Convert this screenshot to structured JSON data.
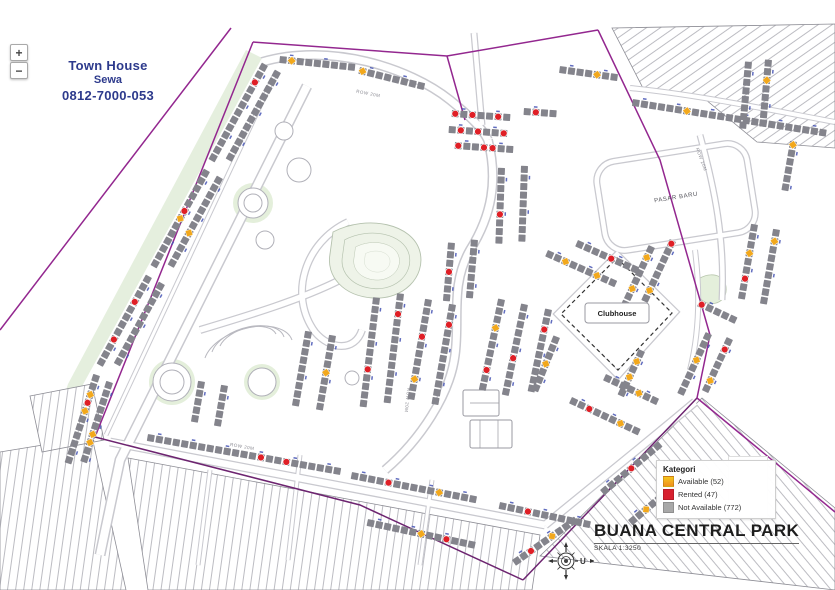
{
  "controls": {
    "zoom_in": "+",
    "zoom_out": "−"
  },
  "ad": {
    "line1": "Town House",
    "line2": "Sewa",
    "line3": "0812-7000-053",
    "color": "#2d3a8c"
  },
  "legend": {
    "title": "Kategori",
    "items": [
      {
        "label": "Available (52)",
        "color": "#f6c61d",
        "color2": "#ef8f1e"
      },
      {
        "label": "Rented (47)",
        "color": "#d7202f"
      },
      {
        "label": "Not Available (772)",
        "color": "#a8a8a8"
      }
    ]
  },
  "footer": {
    "title": "BUANA CENTRAL PARK",
    "scale": "SKALA  1:3250",
    "compass": "U"
  },
  "map": {
    "labels": {
      "clubhouse": "Clubhouse",
      "pasar": "PASAR BARU"
    },
    "road_labels": [
      {
        "t": "ROW 20M",
        "x": 368,
        "y": 95,
        "a": 11
      },
      {
        "t": "ROW 20M",
        "x": 242,
        "y": 448,
        "a": 10
      },
      {
        "t": "ROW 20M",
        "x": 406,
        "y": 400,
        "a": 96
      },
      {
        "t": "ROW 20M",
        "x": 700,
        "y": 160,
        "a": 70
      }
    ],
    "colors": {
      "boundary": "#93278f",
      "unit": "#84848c",
      "rented": "#df1f26",
      "available": "#f2a81c",
      "tick": "#4553b4",
      "road": "#c9c9cf"
    },
    "rows": [
      {
        "x": 268,
        "y": 66,
        "a": 119,
        "n": 13,
        "m": {
          "2": "R"
        }
      },
      {
        "x": 210,
        "y": 172,
        "a": 119,
        "n": 13,
        "m": {
          "5": "R",
          "6": "A"
        }
      },
      {
        "x": 152,
        "y": 278,
        "a": 119,
        "n": 12,
        "m": {
          "3": "R",
          "8": "R"
        }
      },
      {
        "x": 100,
        "y": 376,
        "a": 108,
        "n": 11,
        "m": {
          "2": "A",
          "3": "R",
          "4": "A"
        }
      },
      {
        "x": 281,
        "y": 73,
        "a": 119,
        "n": 12
      },
      {
        "x": 223,
        "y": 179,
        "a": 119,
        "n": 12,
        "m": {
          "7": "A"
        }
      },
      {
        "x": 165,
        "y": 285,
        "a": 119,
        "n": 11
      },
      {
        "x": 113,
        "y": 383,
        "a": 108,
        "n": 10,
        "m": {
          "6": "A",
          "7": "A"
        }
      },
      {
        "x": 280,
        "y": 56,
        "a": 6,
        "n": 9,
        "m": {
          "1": "A"
        }
      },
      {
        "x": 360,
        "y": 67,
        "a": 14,
        "n": 8,
        "m": {
          "0": "A"
        }
      },
      {
        "x": 452,
        "y": 110,
        "a": 4,
        "n": 7,
        "m": {
          "0": "R",
          "2": "R",
          "5": "R"
        }
      },
      {
        "x": 449,
        "y": 126,
        "a": 4,
        "n": 7,
        "m": {
          "1": "R",
          "3": "R",
          "6": "R"
        }
      },
      {
        "x": 455,
        "y": 142,
        "a": 4,
        "n": 7,
        "m": {
          "0": "R",
          "3": "R",
          "4": "R"
        }
      },
      {
        "x": 524,
        "y": 108,
        "a": 4,
        "n": 4,
        "m": {
          "1": "R"
        }
      },
      {
        "x": 560,
        "y": 66,
        "a": 8,
        "n": 7,
        "m": {
          "4": "A"
        }
      },
      {
        "x": 633,
        "y": 99,
        "a": 9,
        "n": 23,
        "m": {
          "6": "A"
        }
      },
      {
        "x": 752,
        "y": 62,
        "a": 95,
        "n": 8
      },
      {
        "x": 772,
        "y": 60,
        "a": 95,
        "n": 8,
        "m": {
          "2": "A"
        }
      },
      {
        "x": 797,
        "y": 142,
        "a": 100,
        "n": 6,
        "m": {
          "0": "A"
        }
      },
      {
        "x": 758,
        "y": 225,
        "a": 100,
        "n": 9,
        "m": {
          "3": "A",
          "6": "R"
        }
      },
      {
        "x": 780,
        "y": 230,
        "a": 100,
        "n": 9,
        "m": {
          "1": "A"
        }
      },
      {
        "x": 380,
        "y": 298,
        "a": 97,
        "n": 13,
        "m": {
          "8": "R"
        }
      },
      {
        "x": 404,
        "y": 294,
        "a": 97,
        "n": 13,
        "m": {
          "2": "R"
        }
      },
      {
        "x": 312,
        "y": 332,
        "a": 100,
        "n": 9
      },
      {
        "x": 336,
        "y": 336,
        "a": 100,
        "n": 9,
        "m": {
          "4": "A"
        }
      },
      {
        "x": 455,
        "y": 243,
        "a": 95,
        "n": 7,
        "m": {
          "3": "R"
        }
      },
      {
        "x": 478,
        "y": 240,
        "a": 95,
        "n": 7
      },
      {
        "x": 432,
        "y": 300,
        "a": 100,
        "n": 12,
        "m": {
          "4": "R",
          "9": "A"
        }
      },
      {
        "x": 456,
        "y": 305,
        "a": 100,
        "n": 12,
        "m": {
          "2": "R"
        }
      },
      {
        "x": 505,
        "y": 168,
        "a": 92,
        "n": 9,
        "m": {
          "5": "R"
        }
      },
      {
        "x": 528,
        "y": 166,
        "a": 92,
        "n": 9
      },
      {
        "x": 505,
        "y": 300,
        "a": 102,
        "n": 11,
        "m": {
          "3": "A",
          "8": "R"
        }
      },
      {
        "x": 528,
        "y": 305,
        "a": 102,
        "n": 11,
        "m": {
          "6": "R"
        }
      },
      {
        "x": 552,
        "y": 310,
        "a": 102,
        "n": 10,
        "m": {
          "2": "R"
        }
      },
      {
        "x": 548,
        "y": 250,
        "a": 24,
        "n": 9,
        "m": {
          "2": "A",
          "6": "A"
        }
      },
      {
        "x": 578,
        "y": 240,
        "a": 24,
        "n": 8,
        "m": {
          "4": "R"
        }
      },
      {
        "x": 655,
        "y": 248,
        "a": 115,
        "n": 8,
        "m": {
          "1": "A",
          "5": "A"
        }
      },
      {
        "x": 676,
        "y": 242,
        "a": 115,
        "n": 8,
        "m": {
          "0": "R",
          "6": "A"
        }
      },
      {
        "x": 560,
        "y": 338,
        "a": 112,
        "n": 7,
        "m": {
          "3": "A"
        }
      },
      {
        "x": 572,
        "y": 397,
        "a": 25,
        "n": 9,
        "m": {
          "2": "R",
          "6": "A"
        }
      },
      {
        "x": 606,
        "y": 374,
        "a": 25,
        "n": 7,
        "m": {
          "4": "A"
        }
      },
      {
        "x": 645,
        "y": 352,
        "a": 115,
        "n": 6,
        "m": {
          "1": "A",
          "3": "A"
        }
      },
      {
        "x": 700,
        "y": 300,
        "a": 25,
        "n": 5,
        "m": {
          "0": "R"
        }
      },
      {
        "x": 712,
        "y": 335,
        "a": 115,
        "n": 8,
        "m": {
          "3": "A"
        }
      },
      {
        "x": 733,
        "y": 340,
        "a": 115,
        "n": 7,
        "m": {
          "1": "R",
          "5": "A"
        }
      },
      {
        "x": 148,
        "y": 434,
        "a": 10,
        "n": 23,
        "m": {
          "13": "R",
          "16": "R"
        }
      },
      {
        "x": 352,
        "y": 472,
        "a": 11,
        "n": 15,
        "m": {
          "4": "R",
          "10": "A"
        }
      },
      {
        "x": 500,
        "y": 502,
        "a": 12,
        "n": 11,
        "m": {
          "3": "R"
        }
      },
      {
        "x": 368,
        "y": 519,
        "a": 12,
        "n": 13,
        "m": {
          "6": "A",
          "9": "R"
        }
      },
      {
        "x": 512,
        "y": 560,
        "a": -35,
        "n": 9,
        "m": {
          "2": "R",
          "5": "A"
        }
      },
      {
        "x": 600,
        "y": 490,
        "a": -40,
        "n": 9,
        "m": {
          "4": "R"
        }
      },
      {
        "x": 628,
        "y": 520,
        "a": -40,
        "n": 8,
        "m": {
          "2": "A"
        }
      },
      {
        "x": 205,
        "y": 382,
        "a": 100,
        "n": 5
      },
      {
        "x": 228,
        "y": 386,
        "a": 100,
        "n": 5
      }
    ]
  }
}
